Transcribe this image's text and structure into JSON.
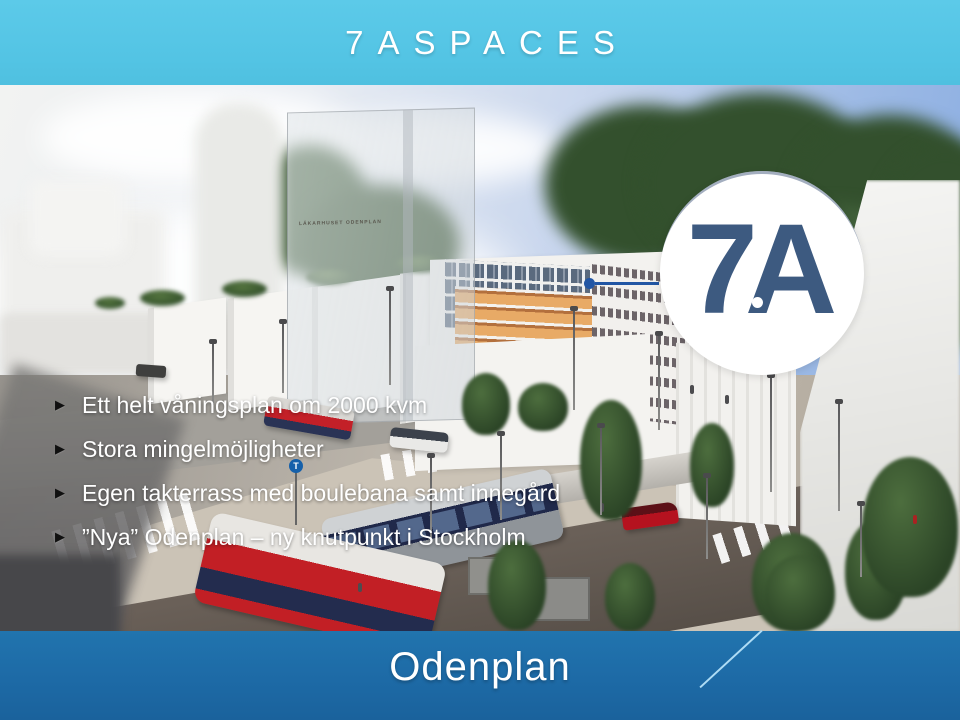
{
  "slide": {
    "title": "7ASPACES",
    "footer_title": "Odenplan"
  },
  "logo": {
    "text": "7A"
  },
  "image": {
    "building_label": "LÄKARHUSET ODENPLAN",
    "metro_sign": "T"
  },
  "bullets": {
    "marker_icon": "▶",
    "items": [
      {
        "text": "Ett helt våningsplan om 2000 kvm"
      },
      {
        "text": "Stora mingelmöjligheter"
      },
      {
        "text": "Egen takterrass med boulebana samt innegård"
      },
      {
        "text": "”Nya” Odenplan – ny knutpunkt i Stockholm"
      }
    ]
  },
  "colors": {
    "header_cyan": "#53c4e4",
    "footer_blue": "#1d6aa6",
    "logo_navy": "#3d5a80",
    "footer_line": "#aedcf5",
    "floor_marker_blue": "#2256a4"
  }
}
